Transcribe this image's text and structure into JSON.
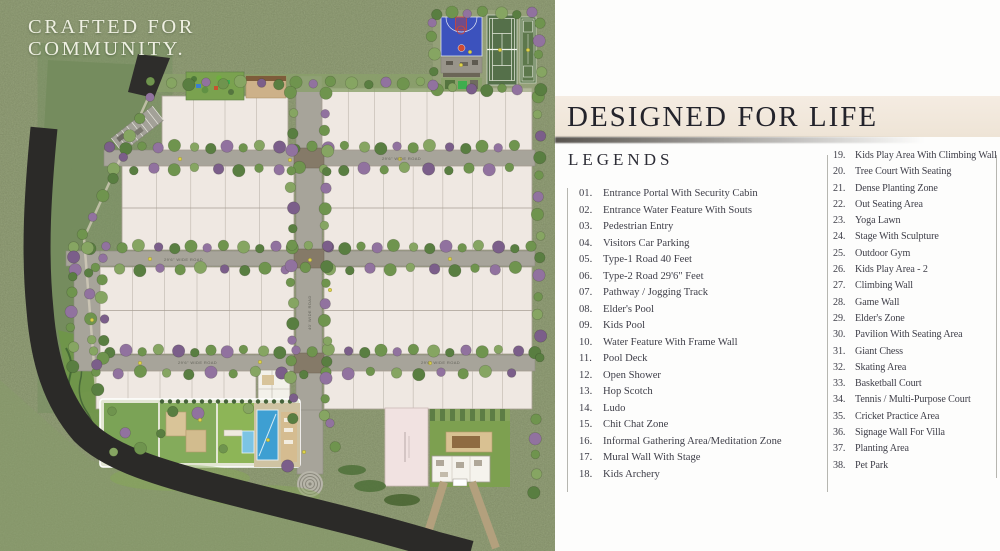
{
  "map": {
    "tagline_line1": "CRAFTED FOR",
    "tagline_line2": "COMMUNITY.",
    "road_label_type2": "29'6\" WIDE ROAD",
    "road_label_type1": "40' WIDE ROAD",
    "colors": {
      "grass": "#92a173",
      "forest": "#75895c",
      "plot": "#efe8e2",
      "plot_border": "#a89f94",
      "road": "#a7a49a",
      "asphalt": "#2b2a28",
      "pool_blue": "#3e9fd2",
      "kids_pool_blue": "#7cc4e4",
      "lawn": "#7ba356",
      "court_blue": "#3c52bd",
      "court_green": "#55704a",
      "deck_tan": "#d5bc90",
      "tree_greens": [
        "#6f944e",
        "#86a562",
        "#597e41"
      ],
      "tree_purples": [
        "#91729f",
        "#7b5e8a"
      ],
      "shrub_yellow": "#ddd24b"
    }
  },
  "panel": {
    "header": "DESIGNED FOR LIFE",
    "legends_title": "LEGENDS",
    "legend_left": [
      {
        "num": "01.",
        "label": "Entrance Portal With Security Cabin"
      },
      {
        "num": "02.",
        "label": "Entrance Water Feature With Souts"
      },
      {
        "num": "03.",
        "label": "Pedestrian Entry"
      },
      {
        "num": "04.",
        "label": "Visitors Car Parking"
      },
      {
        "num": "05.",
        "label": "Type-1 Road 40 Feet"
      },
      {
        "num": "06.",
        "label": "Type-2 Road 29'6\" Feet"
      },
      {
        "num": "07.",
        "label": "Pathway / Jogging Track"
      },
      {
        "num": "08.",
        "label": "Elder's Pool"
      },
      {
        "num": "09.",
        "label": "Kids Pool"
      },
      {
        "num": "10.",
        "label": "Water Feature With Frame Wall"
      },
      {
        "num": "11.",
        "label": "Pool Deck"
      },
      {
        "num": "12.",
        "label": "Open Shower"
      },
      {
        "num": "13.",
        "label": "Hop Scotch"
      },
      {
        "num": "14.",
        "label": "Ludo"
      },
      {
        "num": "15.",
        "label": "Chit Chat Zone"
      },
      {
        "num": "16.",
        "label": "Informal Gathering Area/Meditation Zone"
      },
      {
        "num": "17.",
        "label": "Mural Wall With Stage"
      },
      {
        "num": "18.",
        "label": "Kids Archery"
      }
    ],
    "legend_right": [
      {
        "num": "19.",
        "label": "Kids Play Area With Climbing Wall"
      },
      {
        "num": "20.",
        "label": "Tree Court With Seating"
      },
      {
        "num": "21.",
        "label": "Dense Planting Zone"
      },
      {
        "num": "22.",
        "label": "Out Seating Area"
      },
      {
        "num": "23.",
        "label": "Yoga Lawn"
      },
      {
        "num": "24.",
        "label": "Stage With Sculpture"
      },
      {
        "num": "25.",
        "label": "Outdoor Gym"
      },
      {
        "num": "26.",
        "label": "Kids Play Area - 2"
      },
      {
        "num": "27.",
        "label": "Climbing Wall"
      },
      {
        "num": "28.",
        "label": "Game Wall"
      },
      {
        "num": "29.",
        "label": "Elder's Zone"
      },
      {
        "num": "30.",
        "label": "Pavilion With Seating Area"
      },
      {
        "num": "31.",
        "label": "Giant Chess"
      },
      {
        "num": "32.",
        "label": "Skating Area"
      },
      {
        "num": "33.",
        "label": "Basketball Court"
      },
      {
        "num": "34.",
        "label": "Tennis / Multi-Purpose Court"
      },
      {
        "num": "35.",
        "label": "Cricket Practice Area"
      },
      {
        "num": "36.",
        "label": "Signage Wall For Villa"
      },
      {
        "num": "37.",
        "label": "Planting Area"
      },
      {
        "num": "38.",
        "label": "Pet Park"
      }
    ]
  }
}
